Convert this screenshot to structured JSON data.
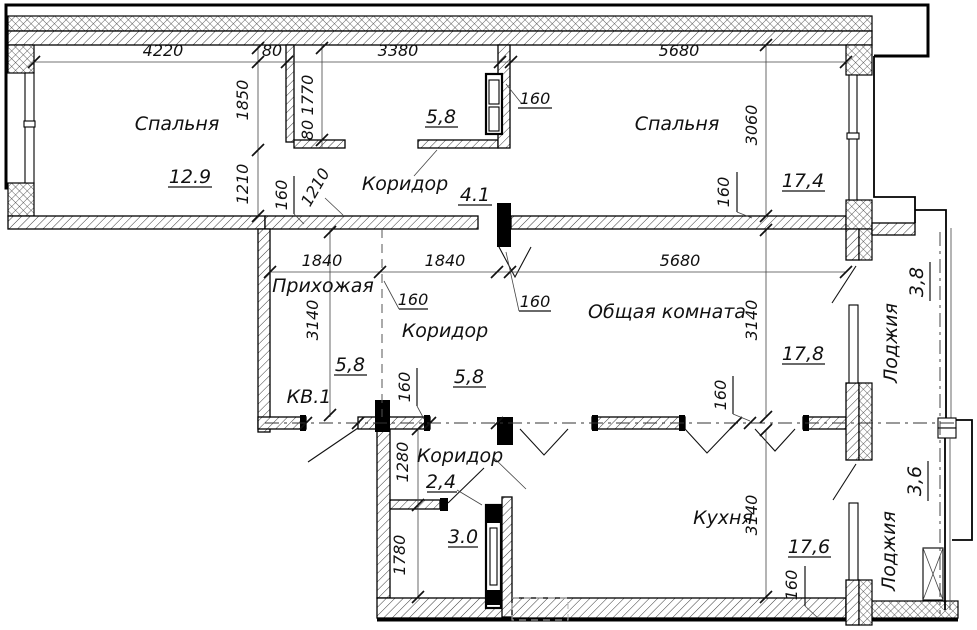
{
  "drawing": {
    "type": "apartment-floor-plan",
    "apartment_label": "КВ.1"
  },
  "labels": {
    "bedroom1": "Спальня",
    "bedroom1_area": "12.9",
    "corridor_top": "Коридор",
    "corridor_top_area": "5,8",
    "corridor41_area": "4.1",
    "bedroom2": "Спальня",
    "bedroom2_area": "17,4",
    "hallway": "Прихожая",
    "apartment": "КВ.1",
    "corridor_mid": "Коридор",
    "corridor_mid_area_left": "5,8",
    "corridor_mid_area_right": "5,8",
    "common_room": "Общая комната",
    "common_room_area": "17,8",
    "loggia_top": "Лоджия",
    "loggia_top_area": "3,8",
    "corridor_low": "Коридор",
    "corridor_low_area": "2,4",
    "corridor_low_area2": "3.0",
    "kitchen": "Кухня",
    "kitchen_area": "17,6",
    "loggia_bottom": "Лоджия",
    "loggia_bottom_area": "3,6"
  },
  "dims": {
    "top_4220": "4220",
    "top_80": "80",
    "top_3380": "3380",
    "top_5680": "5680",
    "left_1850": "1850",
    "left_1210": "1210",
    "niche_1770": "1770",
    "niche_80": "80",
    "niche_160": "160",
    "niche_1210": "1210",
    "shaft_160": "160",
    "bedroom2_3060": "3060",
    "bedroom2_160": "160",
    "mid_1840a": "1840",
    "mid_1840b": "1840",
    "mid_5680": "5680",
    "hall_3140": "3140",
    "hall_160": "160",
    "corridor_160": "160",
    "common_3140": "3140",
    "common_160": "160",
    "door_160": "160",
    "low_1280": "1280",
    "low_1780": "1780",
    "kitchen_3140": "3140",
    "kitchen_160": "160"
  }
}
